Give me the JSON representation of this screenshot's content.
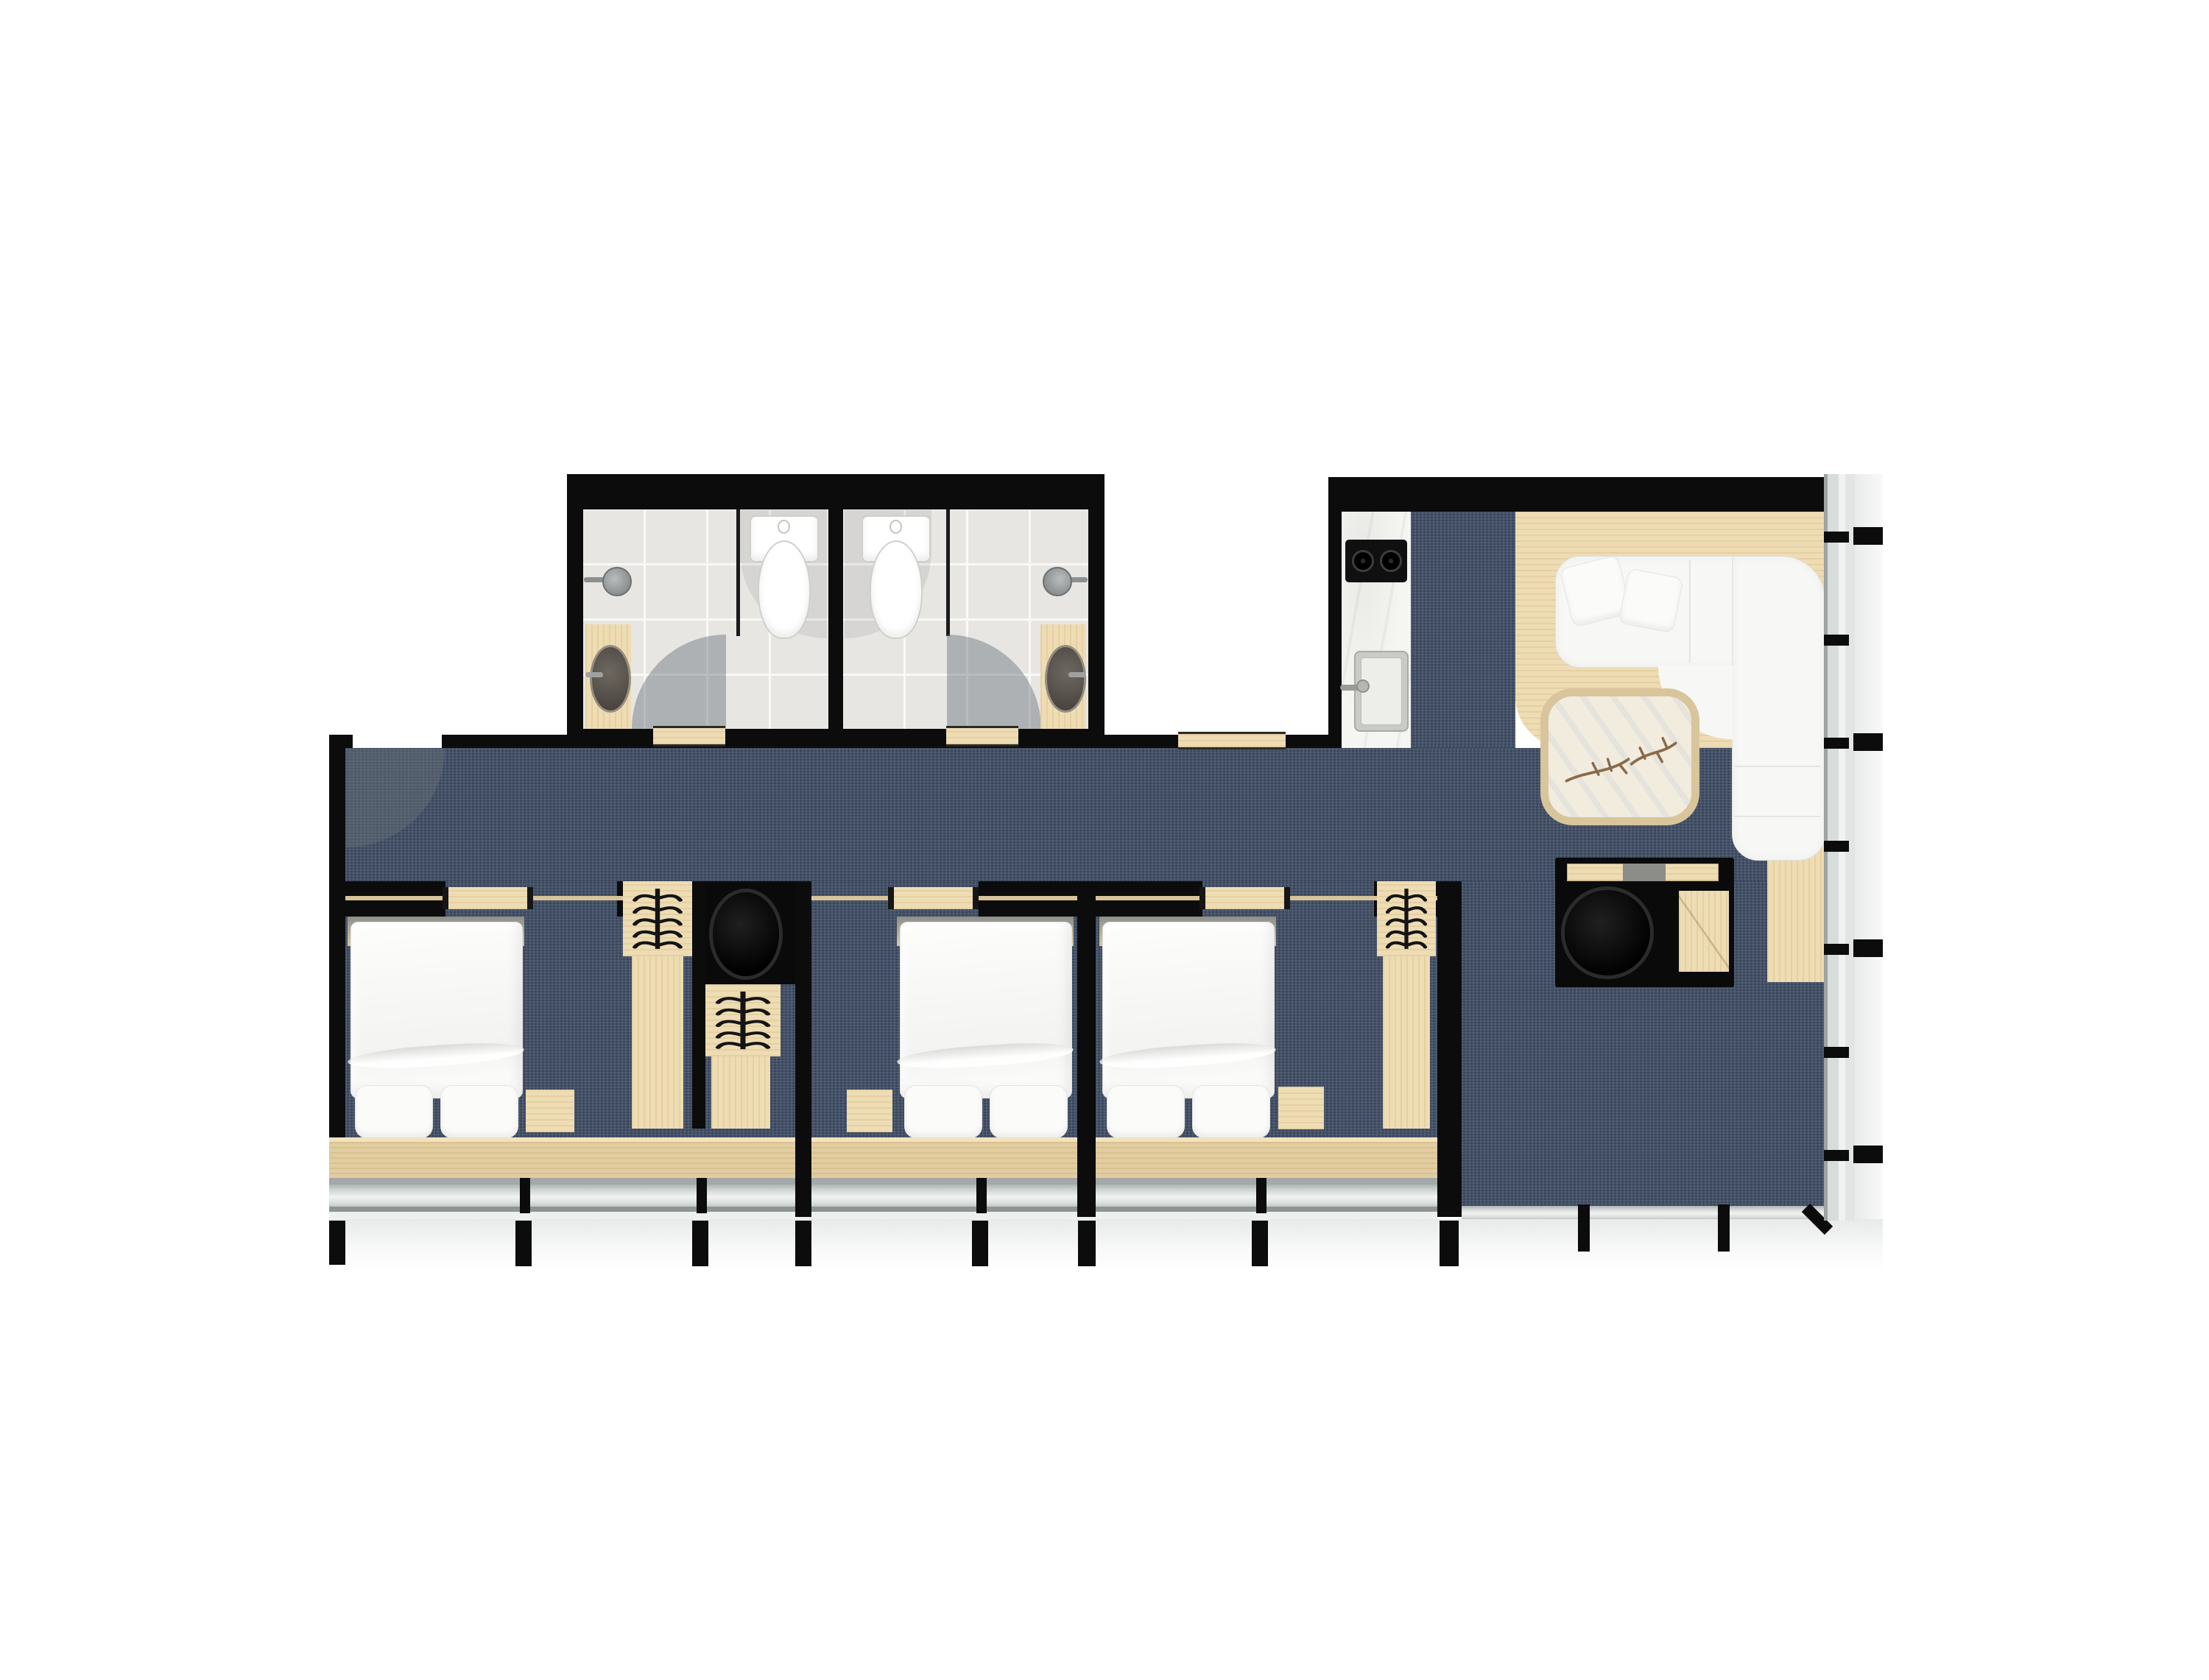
{
  "meta": {
    "kind": "architectural floor plan rendering",
    "view": "top-down",
    "text_labels": []
  },
  "palette": {
    "wall": "#0c0c0d",
    "carpet": "#45536a",
    "wood": "#eedcb3",
    "wood-deep": "#e2cda0",
    "tile": "#e7e6e3",
    "marble": "#f5f5f2",
    "white-furn": "#f7f7f5",
    "glass": "#dfe3e2",
    "outside": "#f3f5f4",
    "arc": "rgba(105,112,120,0.45)",
    "branch": "#8a6a4a"
  },
  "rooms": [
    {
      "id": "bathroom-1",
      "furniture": [
        "toilet",
        "shower-head",
        "vanity-with-round-basin",
        "door-swing-arc",
        "tiled-floor"
      ]
    },
    {
      "id": "bathroom-2",
      "furniture": [
        "toilet",
        "shower-head",
        "vanity-with-round-basin",
        "door-swing-arc",
        "tiled-floor"
      ]
    },
    {
      "id": "hallway",
      "furniture": [
        "entry-door-swing-arc",
        "blue-carpet"
      ]
    },
    {
      "id": "kitchen",
      "furniture": [
        "marble-counter",
        "two-burner-cooktop",
        "kitchen-sink-with-faucet"
      ]
    },
    {
      "id": "living-room",
      "furniture": [
        "wood-floor-platform",
        "l-shaped-white-sofa",
        "two-throw-pillows",
        "coffee-table-with-branch-motif",
        "black-desk",
        "round-black-chair",
        "wood-side-table",
        "glass-curtain-wall"
      ]
    },
    {
      "id": "bedroom-1",
      "furniture": [
        "double-bed-with-two-pillows",
        "wardrobe-with-hangers",
        "black-desk",
        "round-black-stool",
        "second-wardrobe-with-hangers",
        "nightstand",
        "sliding-door"
      ]
    },
    {
      "id": "bedroom-2",
      "furniture": [
        "double-bed-with-two-pillows",
        "nightstand",
        "sliding-door"
      ]
    },
    {
      "id": "bedroom-3",
      "furniture": [
        "double-bed-with-two-pillows",
        "wardrobe-with-hangers",
        "nightstand",
        "sliding-door"
      ]
    }
  ],
  "glazing": {
    "south": "full-width window wall with black mullion posts below bedrooms and living room",
    "east": "glass curtain wall with black mullion ticks"
  }
}
